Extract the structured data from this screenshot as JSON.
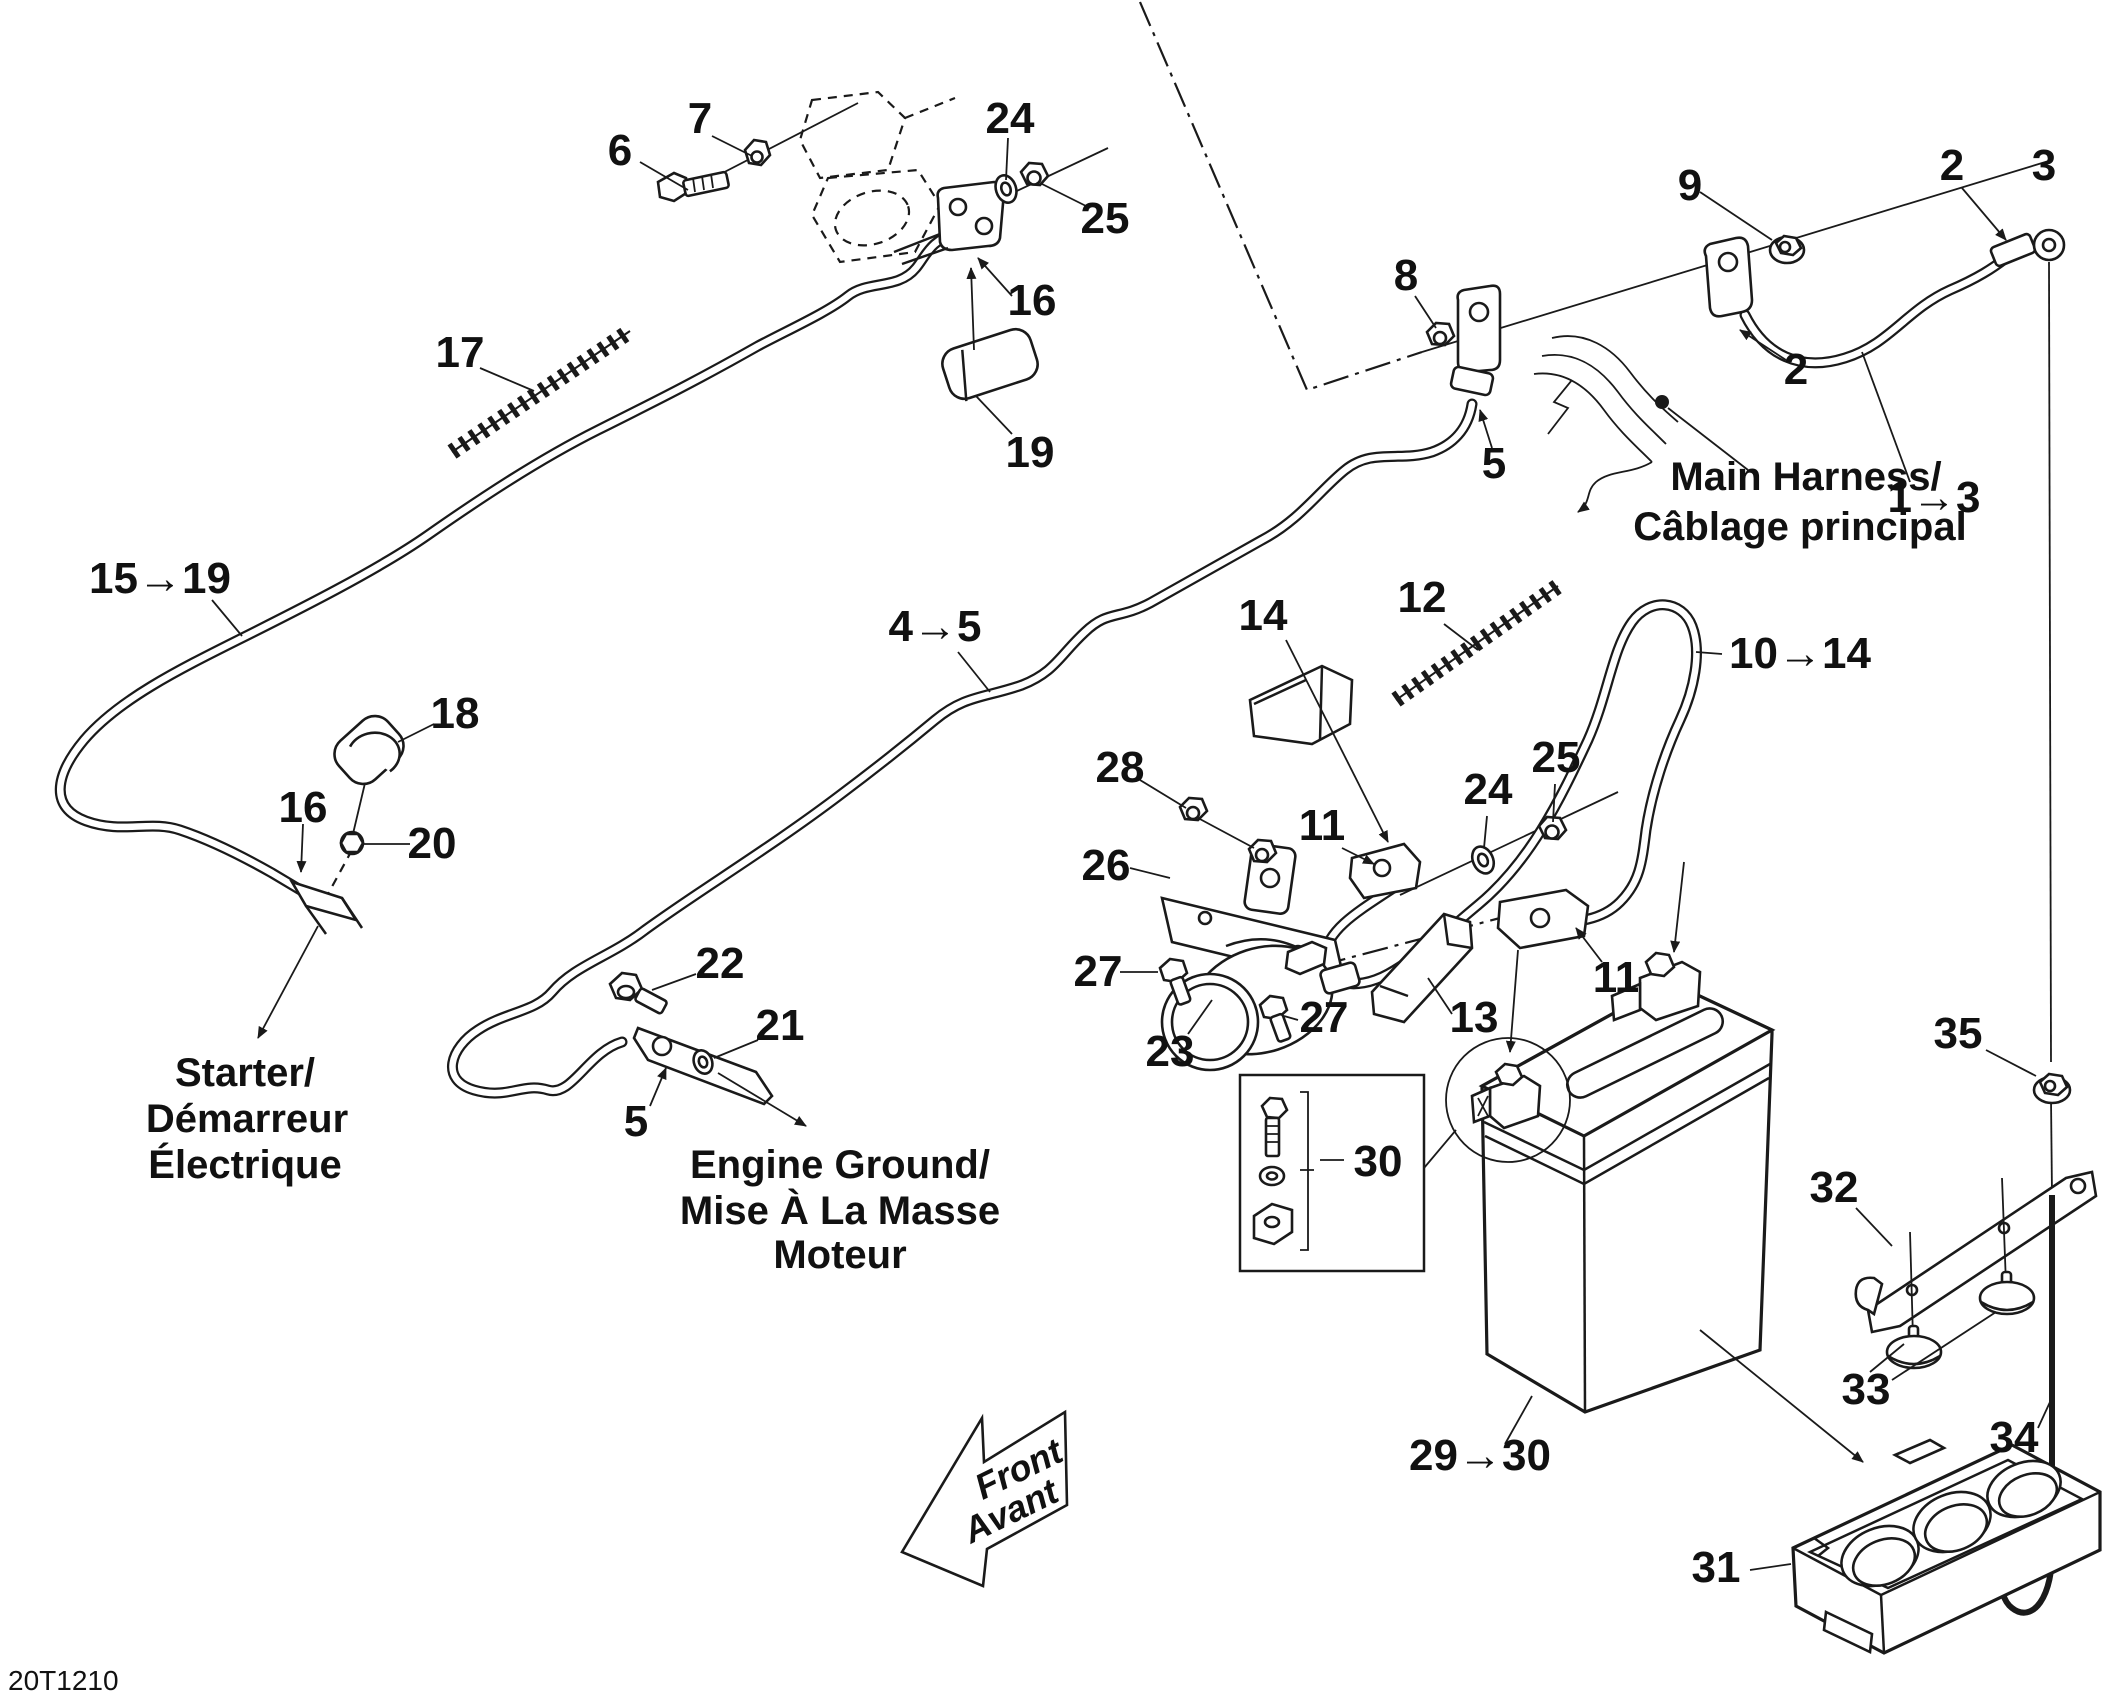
{
  "doc_code": "20T1210",
  "colors": {
    "ink": "#1a1a1a",
    "background": "#ffffff"
  },
  "annotations": {
    "main_harness_line1": "Main Harness/",
    "main_harness_line2": "Câblage principal",
    "starter_line1": "Starter/",
    "starter_line2": "Démarreur",
    "starter_line3": "Électrique",
    "engine_ground_line1": "Engine Ground/",
    "engine_ground_line2": "Mise À La Masse",
    "engine_ground_line3": "Moteur",
    "front_arrow_line1": "Front",
    "front_arrow_line2": "Avant"
  },
  "callouts": {
    "c6": "6",
    "c7": "7",
    "c17": "17",
    "c24a": "24",
    "c25a": "25",
    "c16a": "16",
    "c19": "19",
    "c15_19": "15→19",
    "c18": "18",
    "c16b": "16",
    "c20": "20",
    "c9": "9",
    "c2a": "2",
    "c3": "3",
    "c2b": "2",
    "c1_3": "1→3",
    "c8": "8",
    "c5a": "5",
    "c4_5": "4→5",
    "c22": "22",
    "c21": "21",
    "c5b": "5",
    "c14": "14",
    "c12": "12",
    "c10_14": "10→14",
    "c28": "28",
    "c26": "26",
    "c24b": "24",
    "c25b": "25",
    "c11a": "11",
    "c11b": "11",
    "c27a": "27",
    "c23": "23",
    "c27b": "27",
    "c13": "13",
    "c30": "30",
    "c29_30": "29→30",
    "c31": "31",
    "c32": "32",
    "c33": "33",
    "c34": "34",
    "c35": "35"
  }
}
